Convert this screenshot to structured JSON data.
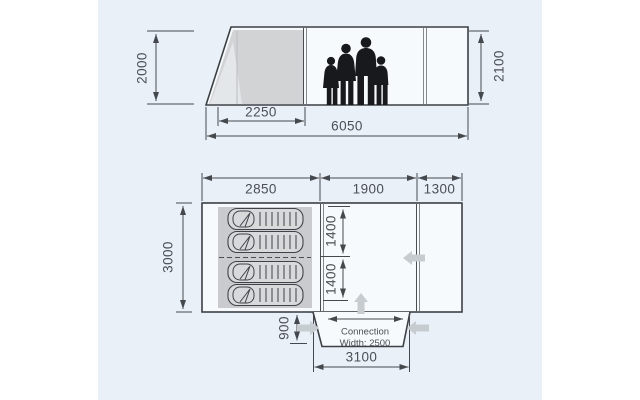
{
  "side_view": {
    "height_left": "2000",
    "height_right": "2100",
    "cabin_width": "2250",
    "total_length": "6050"
  },
  "floor_plan": {
    "sleeping_width": "2850",
    "living_width": "1900",
    "front_width": "1300",
    "depth": "3000",
    "inner_upper": "1400",
    "inner_lower": "1400",
    "tunnel_depth": "900",
    "tunnel_width": "3100",
    "connection_line1": "Connection",
    "connection_line2": "Width: 2500"
  },
  "colors": {
    "panel_bg": "#eaf0f8",
    "tent_fill": "#f7fafc",
    "cabin_gray": "#d2d3d5",
    "sleeping_area_gray": "#c9cbce",
    "outline": "#3c4045",
    "dimension_text": "#4b4f54",
    "entrance_arrow_gray": "#c7ccd1",
    "silhouette": "#17191c"
  }
}
